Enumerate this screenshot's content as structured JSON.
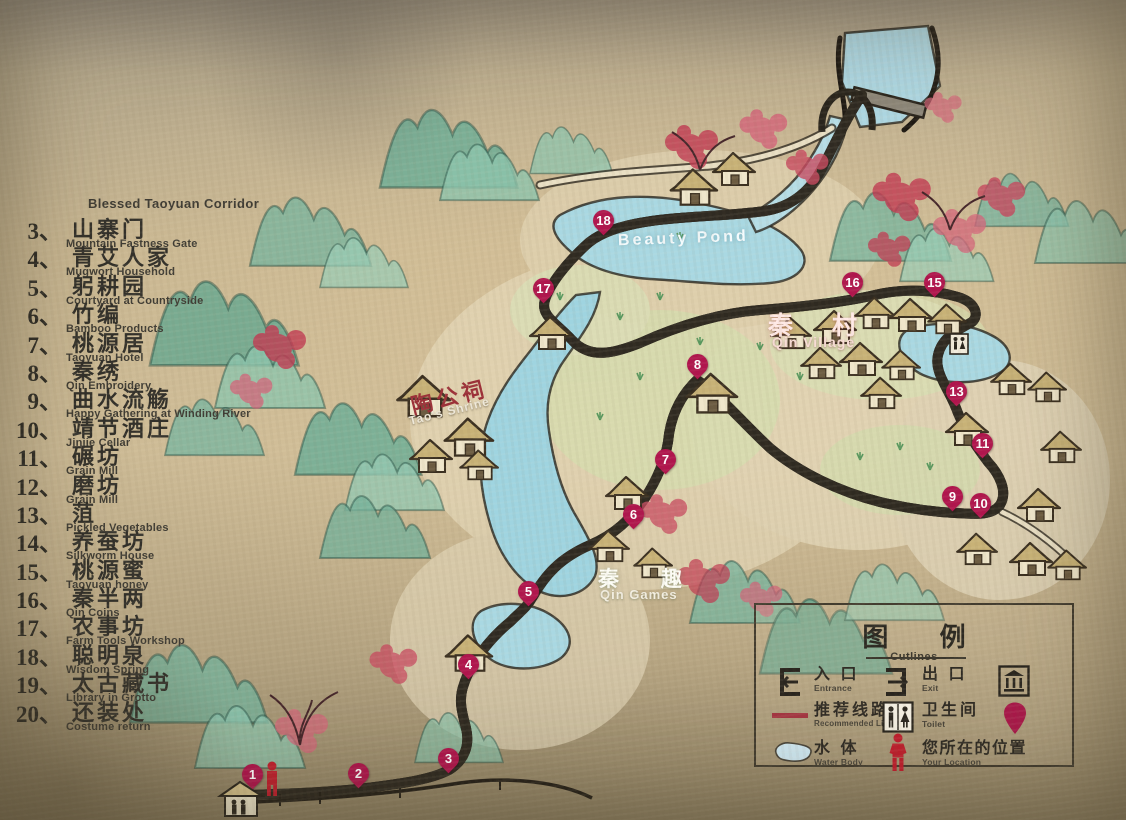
{
  "sidebar": {
    "header_en": "Blessed Taoyuan Corridor",
    "items": [
      {
        "num": "3、",
        "zh": "山寨门",
        "en": "Mountain Fastness Gate"
      },
      {
        "num": "4、",
        "zh": "青艾人家",
        "en": "Mugwort Household"
      },
      {
        "num": "5、",
        "zh": "躬耕园",
        "en": "Courtyard at Countryside"
      },
      {
        "num": "6、",
        "zh": "竹编",
        "en": "Bamboo Products"
      },
      {
        "num": "7、",
        "zh": "桃源居",
        "en": "Taoyuan Hotel"
      },
      {
        "num": "8、",
        "zh": "秦绣",
        "en": "Qin Embroidery"
      },
      {
        "num": "9、",
        "zh": "曲水流觞",
        "en": "Happy Gathering at Winding River"
      },
      {
        "num": "10、",
        "zh": "靖节酒庄",
        "en": "Jinjie Cellar"
      },
      {
        "num": "11、",
        "zh": "碾坊",
        "en": "Grain Mill"
      },
      {
        "num": "12、",
        "zh": "磨坊",
        "en": "Grain Mill"
      },
      {
        "num": "13、",
        "zh": "菹",
        "en": "Pickled Vegetables"
      },
      {
        "num": "14、",
        "zh": "养蚕坊",
        "en": "Silkworm House"
      },
      {
        "num": "15、",
        "zh": "桃源蜜",
        "en": "Taoyuan honey"
      },
      {
        "num": "16、",
        "zh": "秦半两",
        "en": "Qin Coins"
      },
      {
        "num": "17、",
        "zh": "农事坊",
        "en": "Farm Tools Workshop"
      },
      {
        "num": "18、",
        "zh": "聪明泉",
        "en": "Wisdom Spring"
      },
      {
        "num": "19、",
        "zh": "太古藏书",
        "en": "Library in Grotto"
      },
      {
        "num": "20、",
        "zh": "还装处",
        "en": "Costume return"
      }
    ]
  },
  "map": {
    "labels": {
      "beauty_pond_en": "Beauty Pond",
      "qin_village_zh": "秦 村",
      "qin_village_en": "Qin Village",
      "tao_shrine_zh": "陶公祠",
      "tao_shrine_en": "Tao's Shrine",
      "qin_games_zh": "秦 趣",
      "qin_games_en": "Qin Games"
    },
    "markers": [
      {
        "n": "1",
        "x": 252,
        "y": 788
      },
      {
        "n": "2",
        "x": 358,
        "y": 787
      },
      {
        "n": "3",
        "x": 448,
        "y": 772
      },
      {
        "n": "4",
        "x": 468,
        "y": 678
      },
      {
        "n": "5",
        "x": 528,
        "y": 605
      },
      {
        "n": "6",
        "x": 633,
        "y": 528
      },
      {
        "n": "7",
        "x": 665,
        "y": 473
      },
      {
        "n": "8",
        "x": 697,
        "y": 378
      },
      {
        "n": "9",
        "x": 952,
        "y": 510
      },
      {
        "n": "10",
        "x": 980,
        "y": 517
      },
      {
        "n": "11",
        "x": 982,
        "y": 457
      },
      {
        "n": "13",
        "x": 956,
        "y": 405
      },
      {
        "n": "15",
        "x": 934,
        "y": 296
      },
      {
        "n": "16",
        "x": 852,
        "y": 296
      },
      {
        "n": "17",
        "x": 543,
        "y": 302
      },
      {
        "n": "18",
        "x": 603,
        "y": 234
      }
    ]
  },
  "legend": {
    "title_zh": "图 例",
    "title_en": "Cutlines",
    "entrance_zh": "入 口",
    "entrance_en": "Entrance",
    "exit_zh": "出 口",
    "exit_en": "Exit",
    "route_zh": "推荐线路",
    "route_en": "Recommended Line",
    "toilet_zh": "卫生间",
    "toilet_en": "Toilet",
    "water_zh": "水 体",
    "water_en": "Water Body",
    "location_zh": "您所在的位置",
    "location_en": "Your Location"
  },
  "colors": {
    "route": "#a43742",
    "pin": "#b0154d",
    "water": "#a9d8e2"
  }
}
